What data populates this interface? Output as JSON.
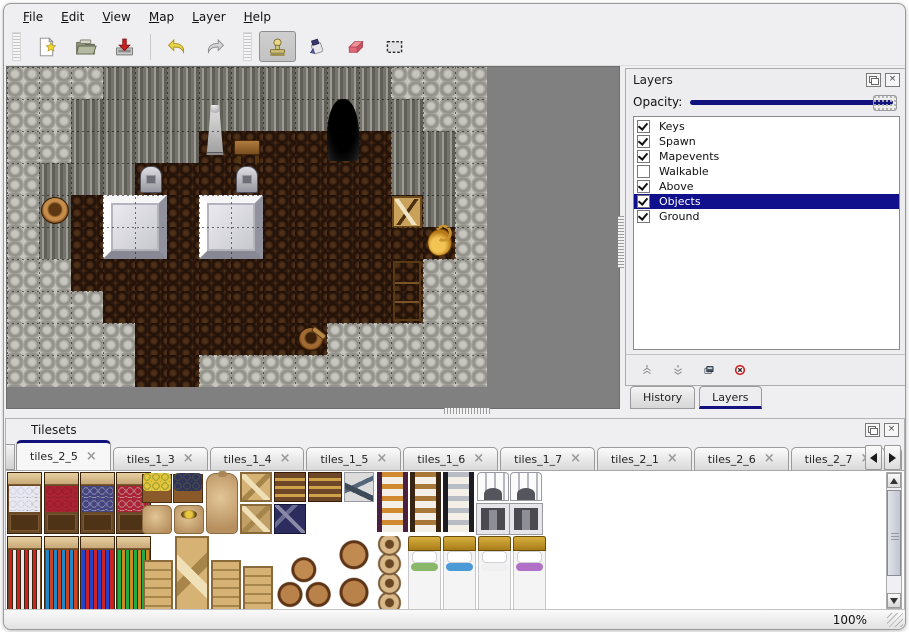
{
  "menu": {
    "items": [
      {
        "label": "File"
      },
      {
        "label": "Edit"
      },
      {
        "label": "View"
      },
      {
        "label": "Map"
      },
      {
        "label": "Layer"
      },
      {
        "label": "Help"
      }
    ]
  },
  "toolbar": {
    "buttons": [
      {
        "name": "new-map",
        "icon": "new-file-icon",
        "active": false
      },
      {
        "name": "open-map",
        "icon": "open-folder-icon",
        "active": false
      },
      {
        "name": "save-map",
        "icon": "save-icon",
        "active": false
      },
      {
        "name": "undo",
        "icon": "undo-arrow-icon",
        "active": false
      },
      {
        "name": "redo",
        "icon": "redo-arrow-icon",
        "active": false
      },
      {
        "name": "stamp-tool",
        "icon": "stamp-icon",
        "active": true
      },
      {
        "name": "fill-tool",
        "icon": "ink-bottle-icon",
        "active": false
      },
      {
        "name": "eraser-tool",
        "icon": "eraser-icon",
        "active": false
      },
      {
        "name": "select-tool",
        "icon": "selection-rect-icon",
        "active": false
      }
    ]
  },
  "layers_panel": {
    "title": "Layers",
    "opacity_label": "Opacity:",
    "opacity_percent": 100,
    "selection_color": "#10108c",
    "layers": [
      {
        "name": "Keys",
        "checked": true,
        "selected": false
      },
      {
        "name": "Spawn",
        "checked": true,
        "selected": false
      },
      {
        "name": "Mapevents",
        "checked": true,
        "selected": false
      },
      {
        "name": "Walkable",
        "checked": false,
        "selected": false
      },
      {
        "name": "Above",
        "checked": true,
        "selected": false
      },
      {
        "name": "Objects",
        "checked": true,
        "selected": true
      },
      {
        "name": "Ground",
        "checked": true,
        "selected": false
      }
    ],
    "buttons": [
      {
        "name": "move-layer-up",
        "icon": "chevrons-up-icon"
      },
      {
        "name": "move-layer-down",
        "icon": "chevrons-down-icon"
      },
      {
        "name": "duplicate-layer",
        "icon": "duplicate-icon"
      },
      {
        "name": "delete-layer",
        "icon": "delete-circle-icon"
      }
    ],
    "tabs": [
      {
        "label": "History",
        "active": false
      },
      {
        "label": "Layers",
        "active": true
      }
    ]
  },
  "tilesets_panel": {
    "title": "Tilesets",
    "close_glyph": "×",
    "tabs": [
      {
        "label": "tiles_2_5",
        "active": true,
        "truncated": false
      },
      {
        "label": "tiles_1_3",
        "active": false,
        "truncated": false
      },
      {
        "label": "tiles_1_4",
        "active": false,
        "truncated": false
      },
      {
        "label": "tiles_1_5",
        "active": false,
        "truncated": false
      },
      {
        "label": "tiles_1_6",
        "active": false,
        "truncated": false
      },
      {
        "label": "tiles_1_7",
        "active": false,
        "truncated": false
      },
      {
        "label": "tiles_2_1",
        "active": false,
        "truncated": false
      },
      {
        "label": "tiles_2_6",
        "active": false,
        "truncated": false
      },
      {
        "label": "tiles_2_7",
        "active": false,
        "truncated": false
      },
      {
        "label": "tiles_2",
        "active": false,
        "truncated": true
      }
    ]
  },
  "status_bar": {
    "zoom_level": "100%"
  },
  "map": {
    "tile_size": 32,
    "legend": {
      "R": "rock-cobble",
      "F": "wall-face",
      "D": "wood-floor"
    },
    "grid": [
      "RRRFFFFFFFFFRRR",
      "RRFFFFFFFFFFFRR",
      "RRFFFFDDDDDDFFR",
      "RFFFDDDDDDDDFFR",
      "RFDDDDDDDDDDDFR",
      "RFDDDDDDDDDDDDR",
      "RRDDDDDDDDDDDRR",
      "RRRDDDDDDDDDDRR",
      "RRRRDDDDDDRRRRR",
      "RRRRDDRRRRRRRRR"
    ],
    "objects": [
      {
        "type": "statue",
        "col": 6,
        "row": 1,
        "w": 1,
        "h": 2
      },
      {
        "type": "table",
        "col": 7,
        "row": 2,
        "w": 1,
        "h": 1
      },
      {
        "type": "cave",
        "col": 10,
        "row": 1,
        "w": 1,
        "h": 2
      },
      {
        "type": "tombstone",
        "col": 4,
        "row": 3,
        "w": 1,
        "h": 1
      },
      {
        "type": "tombstone",
        "col": 7,
        "row": 3,
        "w": 1,
        "h": 1
      },
      {
        "type": "altar",
        "col": 3,
        "row": 4,
        "w": 2,
        "h": 2
      },
      {
        "type": "altar",
        "col": 6,
        "row": 4,
        "w": 2,
        "h": 2
      },
      {
        "type": "pot",
        "col": 1,
        "row": 4,
        "w": 1,
        "h": 1
      },
      {
        "type": "crate",
        "col": 12,
        "row": 4,
        "w": 1,
        "h": 1
      },
      {
        "type": "jug",
        "col": 13,
        "row": 5,
        "w": 1,
        "h": 1
      },
      {
        "type": "shelf",
        "col": 12,
        "row": 6,
        "w": 1,
        "h": 2
      },
      {
        "type": "bucket",
        "col": 9,
        "row": 8,
        "w": 1,
        "h": 1
      }
    ]
  },
  "tileset_content": {
    "items": [
      {
        "kind": "shelfa",
        "x": 0,
        "y": 0,
        "w": 35,
        "h": 62,
        "a1": "#e8e8f2",
        "a2": "#c8c8d8"
      },
      {
        "kind": "shelfa",
        "x": 37,
        "y": 0,
        "w": 35,
        "h": 62,
        "a1": "#aa2233",
        "a2": "#881122"
      },
      {
        "kind": "shelfa",
        "x": 73,
        "y": 0,
        "w": 35,
        "h": 62,
        "a1": "#444480",
        "a2": "#c8c8d8"
      },
      {
        "kind": "shelfa",
        "x": 109,
        "y": 0,
        "w": 35,
        "h": 62,
        "a1": "#aa2233",
        "a2": "#d8d8e2"
      },
      {
        "kind": "planter",
        "x": 135,
        "y": 2,
        "w": 30,
        "h": 29,
        "a1": "#e2c53a"
      },
      {
        "kind": "planter",
        "x": 166,
        "y": 2,
        "w": 30,
        "h": 29,
        "a1": "#32325a"
      },
      {
        "kind": "sack",
        "x": 135,
        "y": 33,
        "w": 30,
        "h": 29
      },
      {
        "kind": "sackopen",
        "x": 167,
        "y": 33,
        "w": 30,
        "h": 29
      },
      {
        "kind": "sackbig",
        "x": 199,
        "y": 1,
        "w": 32,
        "h": 61
      },
      {
        "kind": "cratex",
        "x": 233,
        "y": 0,
        "w": 32,
        "h": 30
      },
      {
        "kind": "cratex dark",
        "x": 233,
        "y": 32,
        "w": 32,
        "h": 30
      },
      {
        "kind": "chest",
        "x": 267,
        "y": 0,
        "w": 32,
        "h": 30
      },
      {
        "kind": "navy",
        "x": 267,
        "y": 32,
        "w": 32,
        "h": 30
      },
      {
        "kind": "chest",
        "x": 301,
        "y": 0,
        "w": 34,
        "h": 30
      },
      {
        "kind": "lumber",
        "x": 337,
        "y": 0,
        "w": 30,
        "h": 30
      },
      {
        "kind": "ladder",
        "x": 370,
        "y": 0,
        "w": 31,
        "h": 60,
        "rail": "#4a2040",
        "rung": "#d08a30"
      },
      {
        "kind": "ladder",
        "x": 403,
        "y": 0,
        "w": 31,
        "h": 60,
        "rail": "#3a2410",
        "rung": "#a87838"
      },
      {
        "kind": "ladder",
        "x": 436,
        "y": 0,
        "w": 31,
        "h": 60,
        "rail": "#1c1c22",
        "rung": "#b8bcc4"
      },
      {
        "kind": "arch",
        "x": 470,
        "y": 0,
        "w": 32,
        "h": 29
      },
      {
        "kind": "door",
        "x": 470,
        "y": 32,
        "w": 32,
        "h": 30
      },
      {
        "kind": "arch",
        "x": 503,
        "y": 0,
        "w": 32,
        "h": 29
      },
      {
        "kind": "door",
        "x": 503,
        "y": 32,
        "w": 32,
        "h": 30
      },
      {
        "kind": "shelfb",
        "x": 0,
        "y": 64,
        "w": 35,
        "h": 75,
        "a1": "#cc2222",
        "a2": "#e8e8f0"
      },
      {
        "kind": "shelfb",
        "x": 37,
        "y": 64,
        "w": 35,
        "h": 75,
        "a1": "#2288cc",
        "a2": "#cc4422"
      },
      {
        "kind": "shelfb",
        "x": 73,
        "y": 64,
        "w": 35,
        "h": 75,
        "a1": "#2244cc",
        "a2": "#cc2222"
      },
      {
        "kind": "shelfb",
        "x": 109,
        "y": 64,
        "w": 35,
        "h": 75,
        "a1": "#22aa44",
        "a2": "#cc8822"
      },
      {
        "kind": "crate",
        "x": 136,
        "y": 88,
        "w": 30,
        "h": 51
      },
      {
        "kind": "cratex",
        "x": 168,
        "y": 64,
        "w": 34,
        "h": 75
      },
      {
        "kind": "crate",
        "x": 204,
        "y": 88,
        "w": 30,
        "h": 51
      },
      {
        "kind": "crate",
        "x": 236,
        "y": 94,
        "w": 30,
        "h": 45
      },
      {
        "kind": "barrels",
        "x": 268,
        "y": 80,
        "w": 60,
        "h": 59
      },
      {
        "kind": "barrel2",
        "x": 330,
        "y": 64,
        "w": 34,
        "h": 75
      },
      {
        "kind": "pots",
        "x": 366,
        "y": 64,
        "w": 33,
        "h": 75
      },
      {
        "kind": "bed",
        "x": 401,
        "y": 64,
        "w": 33,
        "h": 75,
        "acc": "#8ab86a"
      },
      {
        "kind": "bed",
        "x": 436,
        "y": 64,
        "w": 33,
        "h": 75,
        "acc": "#4a9ad8"
      },
      {
        "kind": "bed",
        "x": 471,
        "y": 64,
        "w": 33,
        "h": 75,
        "acc": "#f0f0f0"
      },
      {
        "kind": "bed",
        "x": 506,
        "y": 64,
        "w": 33,
        "h": 75,
        "acc": "#b070c8"
      }
    ]
  }
}
